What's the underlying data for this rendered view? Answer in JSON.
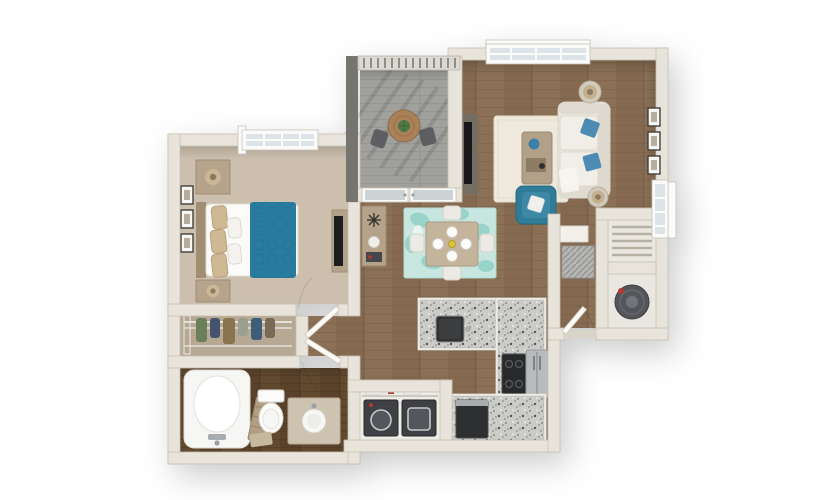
{
  "scene": {
    "description": "3D top-down rendering of a one-bedroom one-bathroom apartment floor plan",
    "background": "#ffffff",
    "rooms": [
      "living-room",
      "dining-area",
      "kitchen",
      "bedroom",
      "walk-in-closet",
      "bathroom",
      "laundry-closet",
      "balcony",
      "entry",
      "utility-closets"
    ]
  },
  "colors": {
    "wall": "#e8e4db",
    "wall_dark": "#76746f",
    "wood_floor": "#8b7056",
    "bath_floor": "#61492f",
    "carpet": "#ccbfae",
    "closet_carpet": "#d2c6b5",
    "balcony_floor": "#a0a09d",
    "granite": "#cbcbc8",
    "accent_teal": "#2a7c9e",
    "accent_teal_chair": "#2e7c98",
    "rug_teal": "#c7e6e0",
    "rug_cream": "#efe9dd",
    "sofa": "#e8e5dd",
    "appliance_dark": "#3e4043",
    "stainless": "#b8bbbe",
    "glass": "#dde4e9",
    "plant": "#4e7a44",
    "table_wood": "#c4b49c",
    "heater_gray": "#54565a"
  },
  "living_room": {
    "furniture": [
      "sofa with blue pillows",
      "teal accent chair",
      "coffee table",
      "tv console",
      "two side tables with lamps",
      "cream area rug"
    ],
    "wall_frames": 3,
    "windows": 2
  },
  "dining_area": {
    "furniture": [
      "square dining table",
      "four white chairs",
      "teal patterned rug",
      "console table"
    ],
    "place_settings": 4
  },
  "kitchen": {
    "fixtures": [
      "granite peninsula with sink",
      "range",
      "refrigerator",
      "dishwasher",
      "granite counters"
    ]
  },
  "bedroom": {
    "furniture": [
      "bed with teal duvet",
      "two nightstands with lamps",
      "dresser with tv"
    ],
    "wall_frames": 3,
    "windows": 1
  },
  "bathroom": {
    "fixtures": [
      "bathtub",
      "toilet",
      "vanity with round sink",
      "towel ladder",
      "bath mat"
    ]
  },
  "laundry_closet": {
    "appliances": [
      "washer",
      "dryer"
    ],
    "shelf_items": [
      "baskets",
      "detergent"
    ]
  },
  "balcony": {
    "furniture": [
      "round bistro table with plant",
      "two chairs"
    ],
    "railing": true
  },
  "utility": {
    "closets": [
      "shelved closet",
      "water-heater closet"
    ],
    "equipment": [
      "hvac-unit"
    ]
  },
  "counts": {
    "dining_chairs": 4,
    "balcony_chairs": 2,
    "wall_frames_total": 6,
    "doors": 4
  }
}
